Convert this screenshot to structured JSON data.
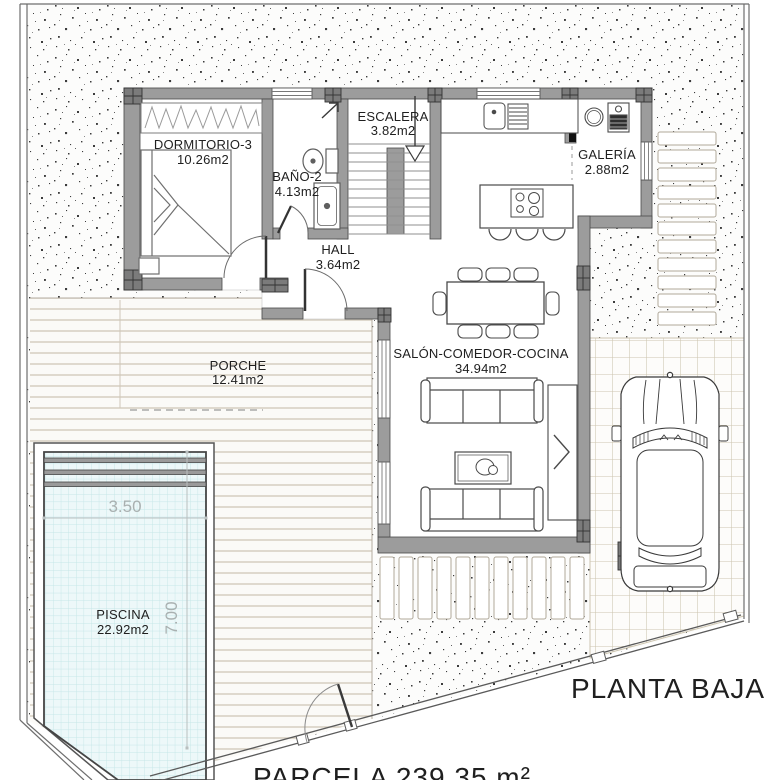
{
  "plan": {
    "title": "PLANTA BAJA",
    "parcel_label": "PARCELA 239,35 m²"
  },
  "rooms": {
    "dormitorio": {
      "name": "DORMITORIO-3",
      "area": "10.26m2"
    },
    "bano": {
      "name": "BAÑO-2",
      "area": "4.13m2"
    },
    "escalera": {
      "name": "ESCALERA",
      "area": "3.82m2"
    },
    "galeria": {
      "name": "GALERÍA",
      "area": "2.88m2"
    },
    "hall": {
      "name": "HALL",
      "area": "3.64m2"
    },
    "porche": {
      "name": "PORCHE",
      "area": "12.41m2"
    },
    "salon": {
      "name": "SALÓN-COMEDOR-COCINA",
      "area": "34.94m2"
    },
    "piscina": {
      "name": "PISCINA",
      "area": "22.92m2"
    }
  },
  "pool_dimensions": {
    "width_label": "3.50",
    "length_label": "7.00"
  },
  "colors": {
    "wall": "#9c9c9c",
    "pillar": "#7b7b7b",
    "pool_water": "#edf8f9",
    "pool_grid": "#c5e6e8",
    "deck_line": "#d3cbbc",
    "tile_line": "#cdc5b0",
    "stipple": "#3c3c3c"
  }
}
